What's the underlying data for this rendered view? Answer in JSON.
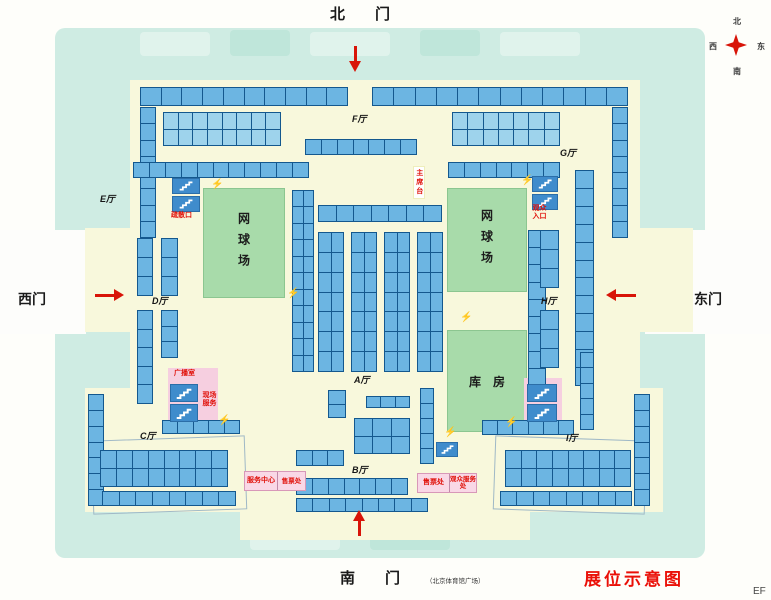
{
  "title": {
    "text": "展位示意图"
  },
  "corner_text": "EF",
  "gates": {
    "north": {
      "label": "北　　门"
    },
    "south": {
      "label": "南　　门",
      "note": "（北京体育馆广场）"
    },
    "west": {
      "label": "西门"
    },
    "east": {
      "label": "东门"
    }
  },
  "compass": {
    "n": "北",
    "s": "南",
    "w": "西",
    "e": "东"
  },
  "halls": [
    {
      "id": "E",
      "label": "E厅",
      "x": 100,
      "y": 192
    },
    {
      "id": "F",
      "label": "F厅",
      "x": 352,
      "y": 112
    },
    {
      "id": "G",
      "label": "G厅",
      "x": 560,
      "y": 146
    },
    {
      "id": "D",
      "label": "D厅",
      "x": 152,
      "y": 294
    },
    {
      "id": "H",
      "label": "H厅",
      "x": 541,
      "y": 294
    },
    {
      "id": "C",
      "label": "C厅",
      "x": 140,
      "y": 429
    },
    {
      "id": "A",
      "label": "A厅",
      "x": 354,
      "y": 373
    },
    {
      "id": "B",
      "label": "B厅",
      "x": 352,
      "y": 463
    },
    {
      "id": "I",
      "label": "I厅",
      "x": 566,
      "y": 431
    }
  ],
  "areas": [
    {
      "id": "tennis-left",
      "label": "网球场",
      "x": 203,
      "y": 188,
      "w": 80,
      "h": 108,
      "vertical": true
    },
    {
      "id": "tennis-right",
      "label": "网球场",
      "x": 447,
      "y": 188,
      "w": 78,
      "h": 102,
      "vertical": true
    },
    {
      "id": "storage",
      "label": "库　房",
      "x": 447,
      "y": 330,
      "w": 78,
      "h": 100,
      "vertical": false
    }
  ],
  "red_labels": [
    {
      "text": "疏散口",
      "x": 171,
      "y": 212,
      "style": "plain",
      "size": 7
    },
    {
      "text": "观众入口",
      "x": 531,
      "y": 205,
      "style": "grid",
      "size": 7,
      "w": 17
    },
    {
      "text": "主席台",
      "x": 413,
      "y": 166,
      "style": "vbox",
      "size": 7
    },
    {
      "text": "广播室",
      "x": 174,
      "y": 370,
      "style": "plain",
      "size": 7
    },
    {
      "text": "现场服务",
      "x": 201,
      "y": 392,
      "style": "grid",
      "size": 7,
      "w": 17
    }
  ],
  "service_boxes": [
    {
      "x": 244,
      "y": 471,
      "w": 62,
      "h": 20,
      "left": "服务中心",
      "right": "售票处"
    },
    {
      "x": 417,
      "y": 473,
      "w": 60,
      "h": 20,
      "left": "售票处",
      "right": "观众服务处"
    }
  ],
  "pink_areas": [
    {
      "x": 168,
      "y": 368,
      "w": 50,
      "h": 56
    },
    {
      "x": 524,
      "y": 378,
      "w": 38,
      "h": 48
    }
  ],
  "hall_outlines": [
    {
      "x": 92,
      "y": 438,
      "w": 152,
      "h": 72,
      "rot": -2
    },
    {
      "x": 494,
      "y": 438,
      "w": 150,
      "h": 72,
      "rot": 2
    }
  ],
  "booths": [
    [
      140,
      87,
      208,
      19,
      1,
      10,
      "std"
    ],
    [
      372,
      87,
      256,
      19,
      1,
      12,
      "std"
    ],
    [
      140,
      107,
      16,
      131,
      8,
      1,
      "std"
    ],
    [
      612,
      107,
      16,
      131,
      8,
      1,
      "std"
    ],
    [
      163,
      112,
      118,
      34,
      2,
      8,
      "light"
    ],
    [
      452,
      112,
      108,
      34,
      2,
      7,
      "light"
    ],
    [
      305,
      139,
      112,
      16,
      1,
      7,
      "std"
    ],
    [
      133,
      162,
      176,
      16,
      1,
      11,
      "std"
    ],
    [
      448,
      162,
      112,
      16,
      1,
      7,
      "std"
    ],
    [
      292,
      190,
      22,
      182,
      11,
      2,
      "std"
    ],
    [
      318,
      205,
      124,
      17,
      1,
      7,
      "std"
    ],
    [
      318,
      232,
      26,
      140,
      7,
      2,
      "std"
    ],
    [
      351,
      232,
      26,
      140,
      7,
      2,
      "std"
    ],
    [
      384,
      232,
      26,
      140,
      7,
      2,
      "std"
    ],
    [
      417,
      232,
      26,
      140,
      7,
      2,
      "std"
    ],
    [
      528,
      230,
      18,
      156,
      9,
      1,
      "std"
    ],
    [
      575,
      170,
      19,
      216,
      12,
      1,
      "std"
    ],
    [
      540,
      230,
      19,
      58,
      3,
      1,
      "std"
    ],
    [
      540,
      310,
      19,
      58,
      3,
      1,
      "std"
    ],
    [
      137,
      238,
      16,
      58,
      3,
      1,
      "std"
    ],
    [
      137,
      310,
      16,
      94,
      5,
      1,
      "std"
    ],
    [
      161,
      238,
      17,
      58,
      3,
      1,
      "std"
    ],
    [
      161,
      310,
      17,
      48,
      3,
      1,
      "std"
    ],
    [
      88,
      394,
      16,
      112,
      7,
      1,
      "std"
    ],
    [
      100,
      450,
      128,
      37,
      2,
      8,
      "std"
    ],
    [
      102,
      491,
      134,
      15,
      1,
      8,
      "std"
    ],
    [
      505,
      450,
      126,
      37,
      2,
      8,
      "std"
    ],
    [
      500,
      491,
      132,
      15,
      1,
      8,
      "std"
    ],
    [
      634,
      394,
      16,
      112,
      7,
      1,
      "std"
    ],
    [
      162,
      420,
      78,
      14,
      1,
      5,
      "std"
    ],
    [
      482,
      420,
      92,
      15,
      1,
      6,
      "std"
    ],
    [
      328,
      390,
      18,
      28,
      2,
      1,
      "std"
    ],
    [
      366,
      396,
      44,
      12,
      1,
      3,
      "std"
    ],
    [
      354,
      418,
      56,
      36,
      2,
      3,
      "std"
    ],
    [
      420,
      388,
      14,
      76,
      5,
      1,
      "std"
    ],
    [
      296,
      450,
      48,
      16,
      1,
      3,
      "std"
    ],
    [
      296,
      478,
      112,
      17,
      1,
      7,
      "std"
    ],
    [
      296,
      498,
      132,
      14,
      1,
      8,
      "std"
    ],
    [
      580,
      352,
      14,
      78,
      5,
      1,
      "std"
    ]
  ],
  "icons": {
    "stairs": [
      [
        172,
        178,
        28,
        16
      ],
      [
        172,
        196,
        28,
        16
      ],
      [
        532,
        176,
        26,
        16
      ],
      [
        532,
        194,
        26,
        16
      ],
      [
        170,
        384,
        28,
        18
      ],
      [
        170,
        404,
        28,
        18
      ],
      [
        527,
        384,
        30,
        18
      ],
      [
        527,
        404,
        30,
        18
      ],
      [
        436,
        442,
        22,
        15
      ]
    ],
    "power": [
      [
        211,
        180
      ],
      [
        521,
        176
      ],
      [
        287,
        289
      ],
      [
        460,
        313
      ],
      [
        218,
        416
      ],
      [
        444,
        428
      ],
      [
        505,
        418
      ]
    ]
  },
  "arrows": [
    {
      "dir": "down",
      "x": 349,
      "y": 46
    },
    {
      "dir": "up",
      "x": 353,
      "y": 510
    },
    {
      "dir": "right",
      "x": 95,
      "y": 289
    },
    {
      "dir": "left",
      "x": 606,
      "y": 289
    }
  ],
  "colors": {
    "booth_fill": "#6cb5e2",
    "booth_fill_light": "#9ed3ec",
    "booth_line": "#14588e",
    "red": "#e01008"
  }
}
